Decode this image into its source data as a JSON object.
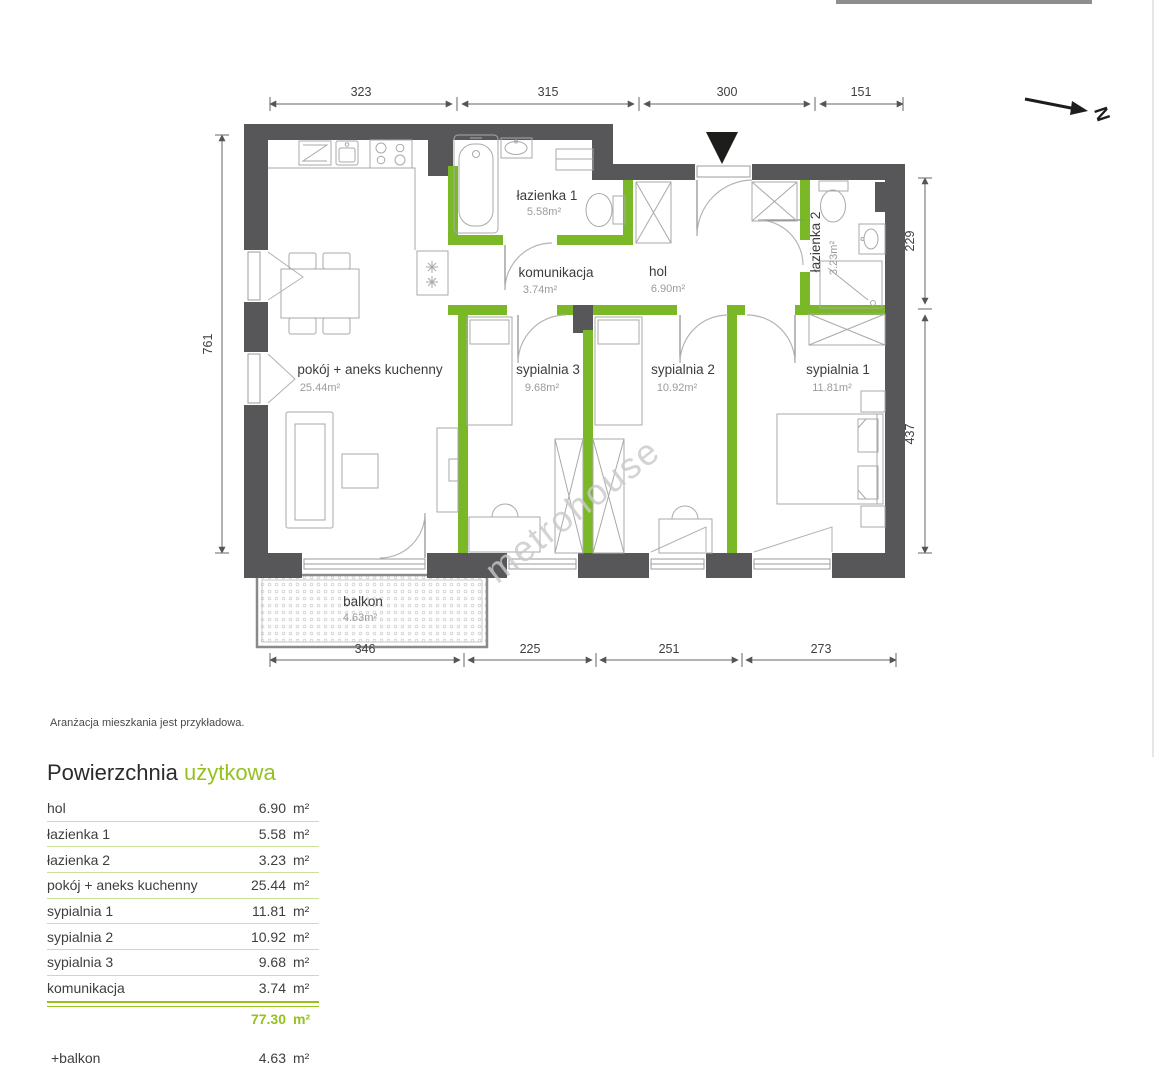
{
  "meta": {
    "note": "Aranżacja mieszkania jest przykładowa.",
    "watermark": "metrohouse",
    "north_label": "N"
  },
  "colors": {
    "accent_green": "#95c11f",
    "wall_green": "#7bb828",
    "wall_gray": "#57575a"
  },
  "plan": {
    "rooms": [
      {
        "name": "łazienka 1",
        "area": "5.58m²"
      },
      {
        "name": "komunikacja",
        "area": "3.74m²"
      },
      {
        "name": "hol",
        "area": "6.90m²"
      },
      {
        "name": "łazienka 2",
        "area": "3.23m²"
      },
      {
        "name": "pokój + aneks kuchenny",
        "area": "25.44m²"
      },
      {
        "name": "sypialnia 3",
        "area": "9.68m²"
      },
      {
        "name": "sypialnia 2",
        "area": "10.92m²"
      },
      {
        "name": "sypialnia 1",
        "area": "11.81m²"
      },
      {
        "name": "balkon",
        "area": "4.63m²"
      }
    ],
    "dims": {
      "top": [
        "323",
        "315",
        "300",
        "151"
      ],
      "bottom": [
        "346",
        "225",
        "251",
        "273"
      ],
      "left": [
        "761"
      ],
      "right": [
        "229",
        "437"
      ]
    }
  },
  "table": {
    "title_dark": "Powierzchnia",
    "title_green": "użytkowa",
    "rows": [
      {
        "label": "hol",
        "value": "6.90",
        "unit": "m²"
      },
      {
        "label": "łazienka 1",
        "value": "5.58",
        "unit": "m²"
      },
      {
        "label": "łazienka 2",
        "value": "3.23",
        "unit": "m²"
      },
      {
        "label": "pokój + aneks kuchenny",
        "value": "25.44",
        "unit": "m²"
      },
      {
        "label": "sypialnia 1",
        "value": "11.81",
        "unit": "m²"
      },
      {
        "label": "sypialnia 2",
        "value": "10.92",
        "unit": "m²"
      },
      {
        "label": "sypialnia 3",
        "value": "9.68",
        "unit": "m²"
      },
      {
        "label": "komunikacja",
        "value": "3.74",
        "unit": "m²"
      }
    ],
    "total": {
      "value": "77.30",
      "unit": "m²"
    },
    "extra": {
      "label": "+balkon",
      "value": "4.63",
      "unit": "m²"
    }
  }
}
